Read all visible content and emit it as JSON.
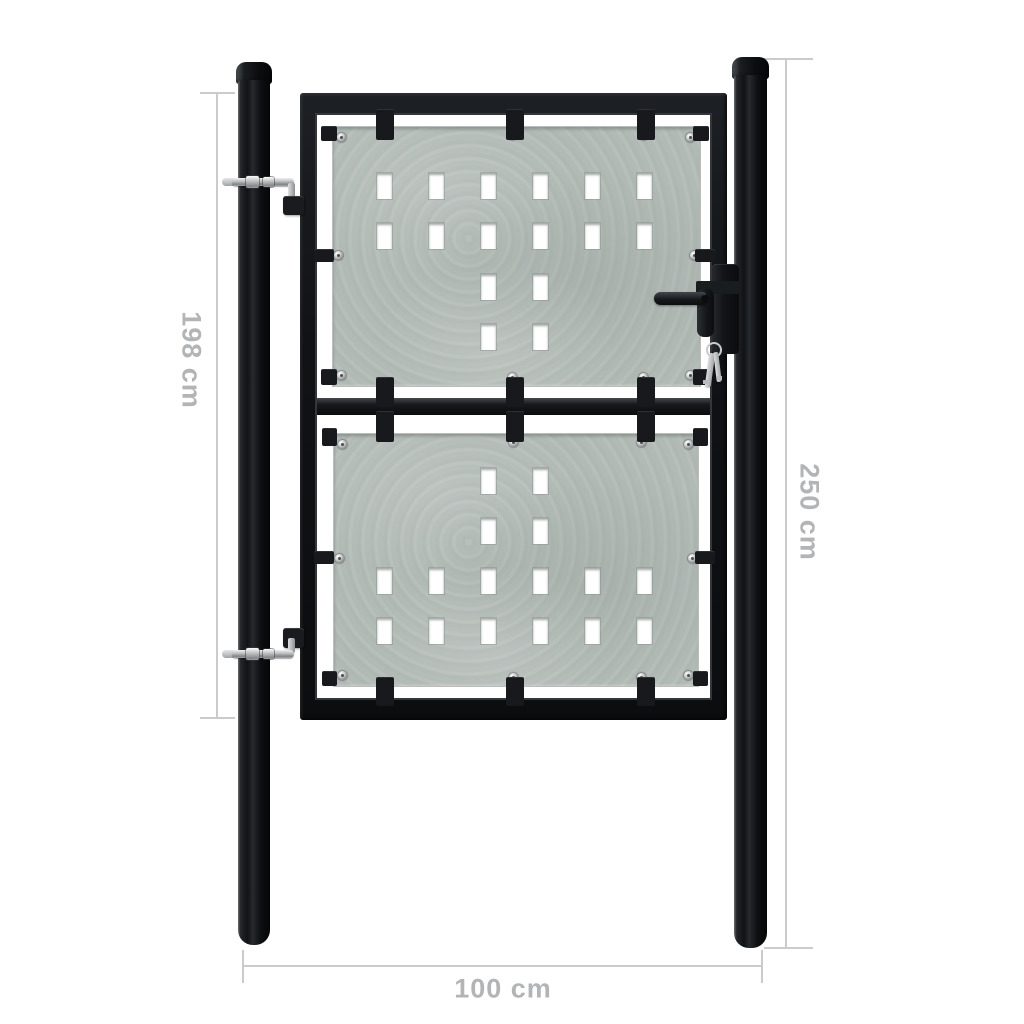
{
  "meta": {
    "background": "#ffffff",
    "description_visible_text_only": true
  },
  "dimensions": {
    "left": {
      "label": "198 cm",
      "orientation": "vertical"
    },
    "right": {
      "label": "250 cm",
      "orientation": "vertical"
    },
    "bottom": {
      "label": "100 cm",
      "orientation": "horizontal"
    }
  },
  "colors": {
    "dim_line": "#c9cbcd",
    "dim_text": "#b2b4b6",
    "steel_dark": "#14161a",
    "panel_base": "#b2bab6",
    "hole_fill": "#ffffff",
    "hardware_silver": "#c9cacb"
  },
  "panels": {
    "upper": {
      "hole_pattern": [
        [
          1,
          1,
          1,
          1,
          1,
          1
        ],
        [
          1,
          1,
          1,
          1,
          1,
          1
        ],
        [
          0,
          0,
          1,
          1,
          0,
          0
        ],
        [
          0,
          0,
          1,
          1,
          0,
          0
        ]
      ]
    },
    "lower": {
      "hole_pattern": [
        [
          0,
          0,
          1,
          1,
          0,
          0
        ],
        [
          0,
          0,
          1,
          1,
          0,
          0
        ],
        [
          1,
          1,
          1,
          1,
          1,
          1
        ],
        [
          1,
          1,
          1,
          1,
          1,
          1
        ]
      ]
    }
  }
}
